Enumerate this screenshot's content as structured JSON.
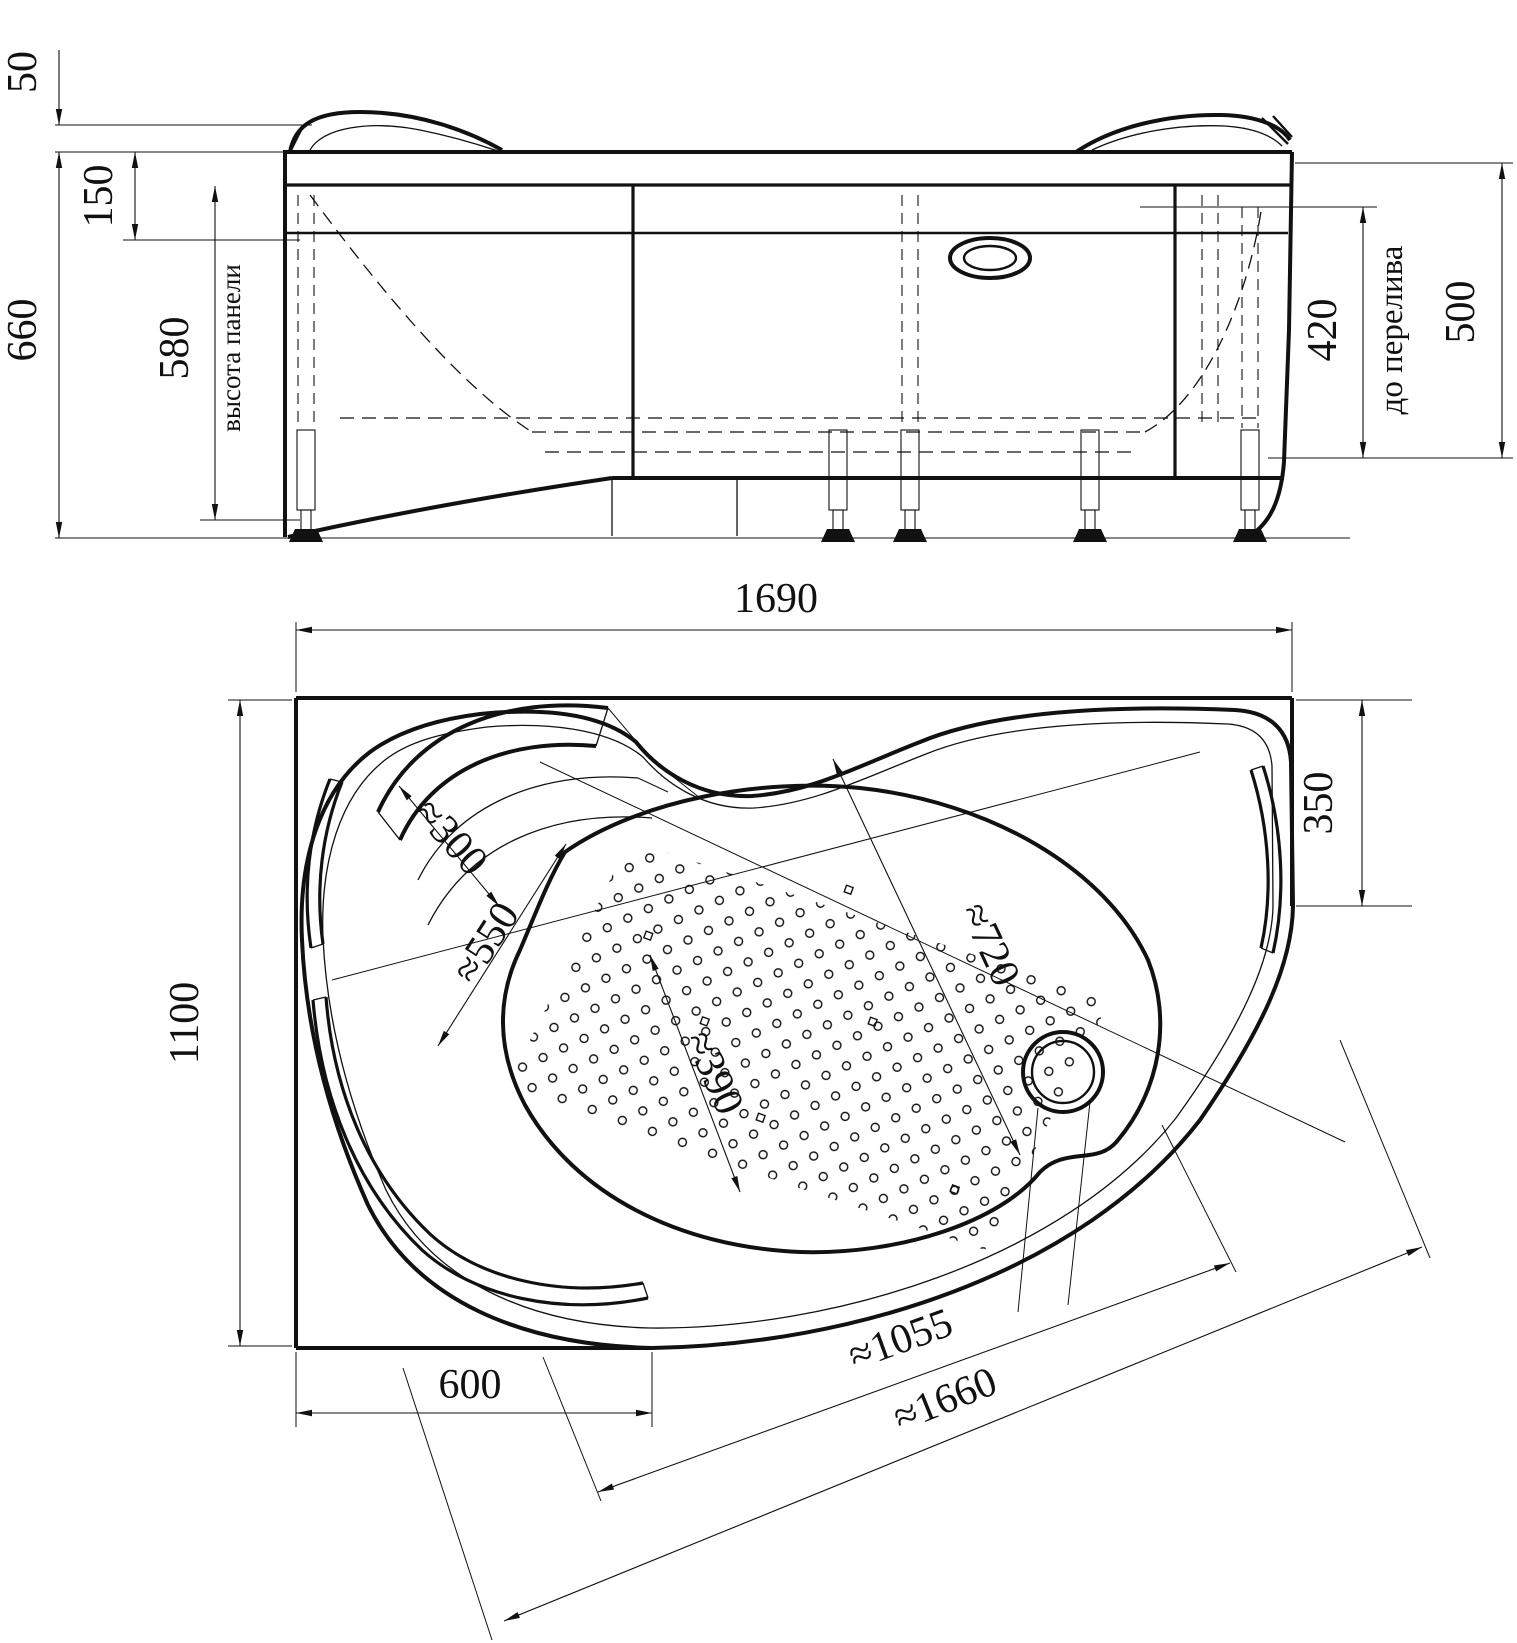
{
  "drawing": {
    "type": "bathtub technical drawing, front elevation and plan view",
    "front_view": {
      "dims": {
        "d50": "50",
        "d150": "150",
        "d660": "660",
        "d580": "580",
        "panel_height_label": "высота панели",
        "d420": "420",
        "overflow_label": "до перелива",
        "d500": "500"
      }
    },
    "plan_view": {
      "dims": {
        "d1690": "1690",
        "d1100": "1100",
        "d350": "350",
        "d600": "600",
        "d300": "≈300",
        "d550": "≈550",
        "d720": "≈720",
        "d390": "≈390",
        "d1055": "≈1055",
        "d1660": "≈1660"
      }
    }
  }
}
